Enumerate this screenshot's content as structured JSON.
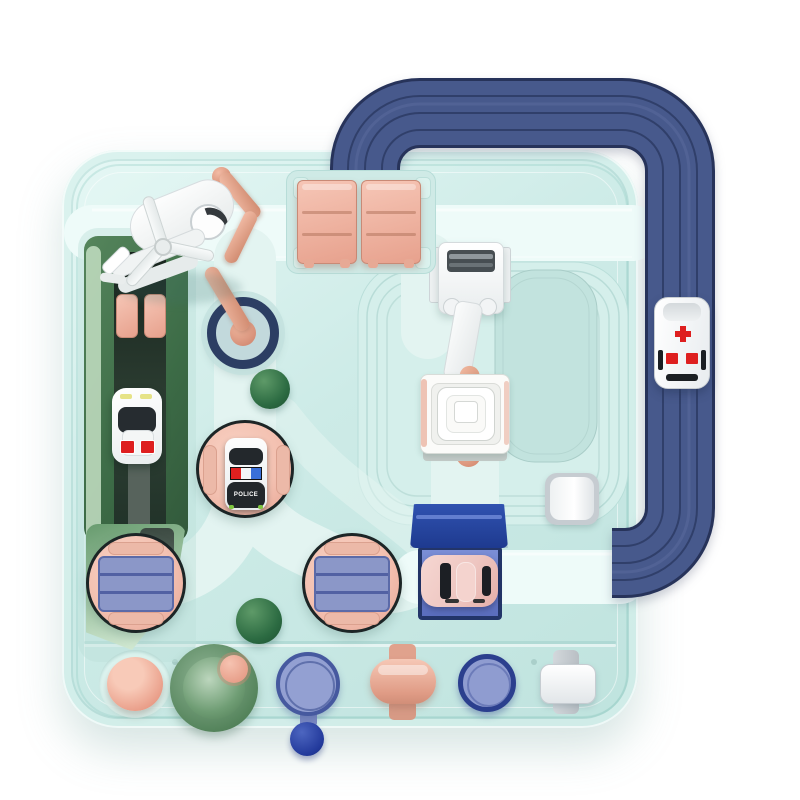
{
  "image": {
    "type": "product-photo",
    "subject": "Children's rail-car adventure track playset, top-down view on white background"
  },
  "text": {
    "police": "POLICE"
  },
  "palette": {
    "bg": "#ffffff",
    "boardBase": "#cdebe7",
    "boardLight": "#e6f8f5",
    "boardShade": "#bfe3de",
    "lane": "#eefbf9",
    "laneSoft": "#e3f4f1",
    "platform": "#d5efeb",
    "platformLine": "#b3d8d3",
    "hole": "#c2e3de",
    "navy": "#47598c",
    "navyEdge": "#27335a",
    "navyLine": "#2d3b64",
    "royal": "#1e3a8f",
    "stripeBlue": "#8b97c8",
    "stripeLine": "#44549a",
    "navyBall": "#22399b",
    "pink": "#f3c0b0",
    "pinkDeep": "#e7a392",
    "copper": "#dd9a82",
    "greenDark": "#3c6b46",
    "greenMid": "#679b6e",
    "greenPale": "#cfe7d0",
    "ballGreen": "#2c6b42",
    "red": "#de1f1f",
    "tirePink": "#eec6c1"
  },
  "parts": {
    "board": "mint game board",
    "overhead_track": "navy elevated rail loop",
    "gate": "pink double swing gate",
    "crane": "white lift crane with copper handle",
    "pivot": "copper lever on navy pivot ring",
    "ramp": "green launch ramp",
    "turntables": "two pink turntables with blue plates",
    "police_pad": "pink circular pad with police car",
    "vehicles": [
      "ambulance",
      "police-car",
      "rescue-car",
      "pink-car",
      "white-helicopter"
    ],
    "buttons": [
      "pink-dome",
      "green-cone",
      "periwinkle-dial",
      "pink-roller",
      "blue-button",
      "white-button"
    ]
  }
}
